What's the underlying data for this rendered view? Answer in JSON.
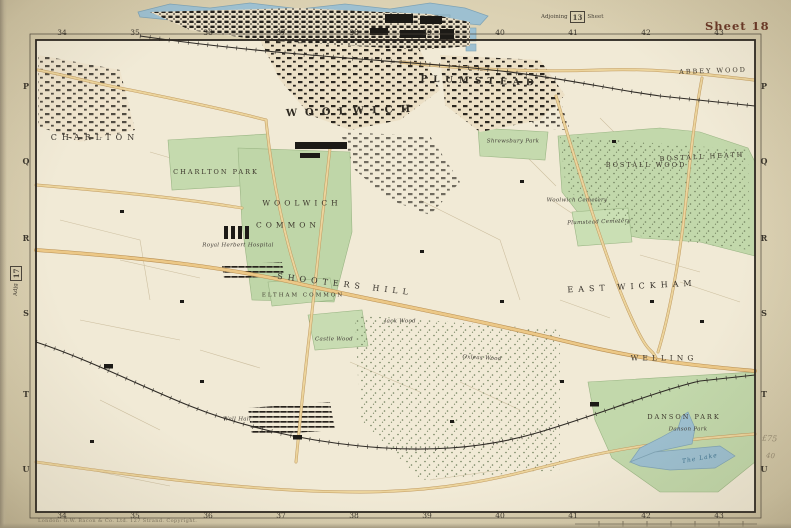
{
  "page": {
    "sheet_title": "Sheet 18",
    "adjoining_top": {
      "prefix": "Adjoining",
      "number": "13",
      "suffix": "Sheet"
    },
    "adjoining_left": {
      "prefix": "Adjg",
      "number": "17",
      "suffix": "Sheet"
    },
    "imprint": "London: G.W. Bacon & Co. Ltd. 127 Strand.   Copyright.",
    "pencil_notes": [
      "£75",
      "40"
    ]
  },
  "palette": {
    "paper": "#ddd3b5",
    "map_ground": "#f1ead6",
    "water": "#9dc0d1",
    "park_green": "#c5daae",
    "road_tan": "#ecc987",
    "urban_black": "#23201b",
    "neatline": "#2b2620",
    "sheet_title_red": "#693625"
  },
  "grid": {
    "top": [
      "34",
      "35",
      "36",
      "37",
      "38",
      "39",
      "40",
      "41",
      "42",
      "43"
    ],
    "bottom": [
      "34",
      "35",
      "36",
      "37",
      "38",
      "39",
      "40",
      "41",
      "42",
      "43"
    ],
    "left": [
      "P",
      "Q",
      "R",
      "S",
      "T",
      "U"
    ],
    "right": [
      "P",
      "Q",
      "R",
      "S",
      "T",
      "U"
    ]
  },
  "labels": [
    {
      "text": "WOOLWICH"
    },
    {
      "text": "PLUMSTEAD"
    },
    {
      "text": "CHARLTON"
    },
    {
      "text": "CHARLTON PARK"
    },
    {
      "text": "WOOLWICH"
    },
    {
      "text": "COMMON"
    },
    {
      "text": "SHOOTERS HILL"
    },
    {
      "text": "ELTHAM COMMON"
    },
    {
      "text": "EAST WICKHAM"
    },
    {
      "text": "WELLING"
    },
    {
      "text": "DANSON PARK"
    },
    {
      "text": "Danson Park"
    },
    {
      "text": "The Lake"
    },
    {
      "text": "ABBEY WOOD"
    },
    {
      "text": "BOSTALL WOOD"
    },
    {
      "text": "BOSTALL HEATH"
    },
    {
      "text": "Woolwich Cemetery"
    },
    {
      "text": "Plumstead Cemetery"
    },
    {
      "text": "Royal Herbert Hospital"
    },
    {
      "text": "Castle Wood"
    },
    {
      "text": "Jack Wood"
    },
    {
      "text": "Oxleas Wood"
    },
    {
      "text": "Shrewsbury Park"
    },
    {
      "text": "Well Hall"
    }
  ]
}
